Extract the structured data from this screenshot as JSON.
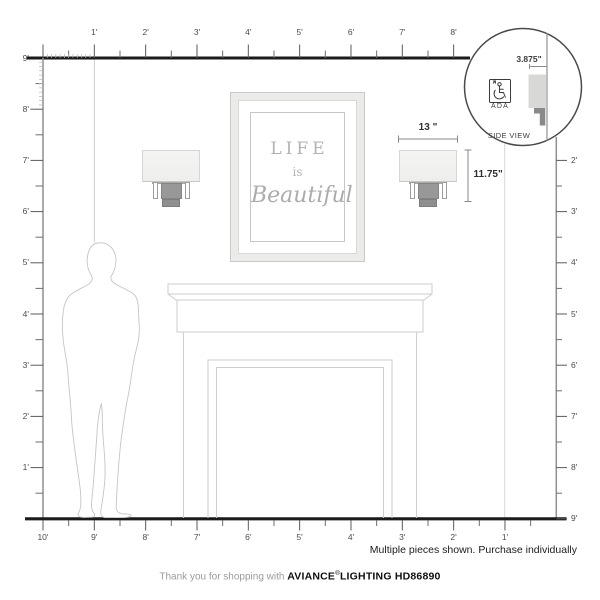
{
  "rulers": {
    "top": [
      "1'",
      "2'",
      "3'",
      "4'",
      "5'",
      "6'",
      "7'",
      "8'"
    ],
    "left": [
      "9'",
      "8'",
      "7'",
      "6'",
      "5'",
      "4'",
      "3'",
      "2'",
      "1'"
    ],
    "right": [
      "2'",
      "3'",
      "4'",
      "5'",
      "6'",
      "7'",
      "8'",
      "9'"
    ],
    "bottom": [
      "10'",
      "9'",
      "8'",
      "7'",
      "6'",
      "5'",
      "4'",
      "3'",
      "2'",
      "1'"
    ]
  },
  "artwork": {
    "line1": "LIFE",
    "line2": "is",
    "line3": "Beautiful"
  },
  "dimensions": {
    "sconce_width": "13 \"",
    "sconce_height": "11.75\""
  },
  "inset": {
    "depth": "3.875\"",
    "ada": "ADA",
    "caption": "SIDE VIEW"
  },
  "footer": {
    "notice": "Multiple pieces shown. Purchase individually",
    "thanks": "Thank you for shopping with ",
    "brand": "AVIANCE",
    "reg": "®",
    "brand_suffix": "LIGHTING",
    "model": "HD86890"
  },
  "icons": {
    "ada": "wheelchair-symbol"
  },
  "colors": {
    "ruler_dark": "#1b1b1b",
    "ruler_gray": "#8f8f8f",
    "tick": "#5a5a5a",
    "outline_light": "#cdcdcd",
    "person_outline": "#c5c5c5",
    "shade_fill": "#f1f1f0",
    "bracket_fill": "#969696",
    "art_text": "#b2b2b2",
    "inset_stroke": "#4a4a4a"
  }
}
